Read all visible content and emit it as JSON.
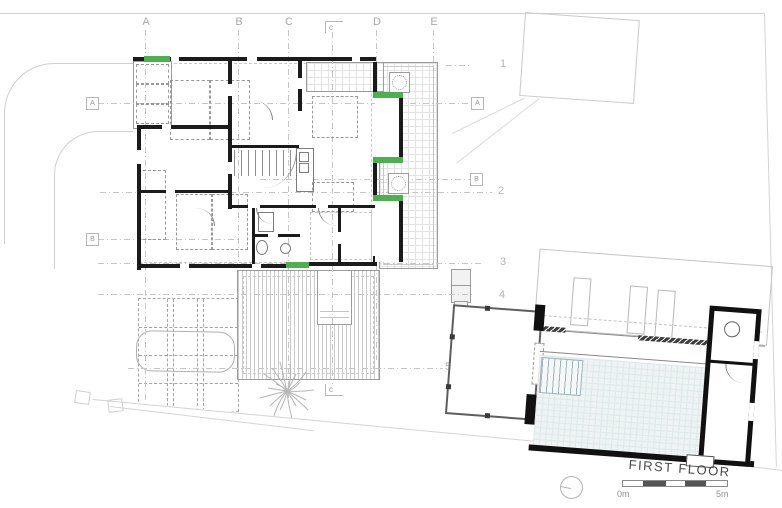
{
  "title": {
    "text": "FIRST FLOOR"
  },
  "grid": {
    "columns": [
      "A",
      "B",
      "C",
      "D",
      "E"
    ],
    "rows": [
      "1",
      "2",
      "3",
      "4",
      "5"
    ],
    "section_markers_left": [
      "A",
      "B"
    ],
    "section_markers_right": [
      "A",
      "B"
    ],
    "section_c_label": "c"
  },
  "scale_bar": {
    "start": "0m",
    "end": "5m"
  },
  "colors": {
    "accent_green": "#4caf50",
    "wall": "#1b1b1b",
    "grid_line": "#c6c6c6",
    "site_line": "#d4d4d4",
    "pool_fill": "#eef3f4",
    "label": "#a8a8a8"
  },
  "icons": {
    "tree": "tree-icon",
    "north_indicator": "north-indicator-icon",
    "planter": "planter-icon"
  }
}
